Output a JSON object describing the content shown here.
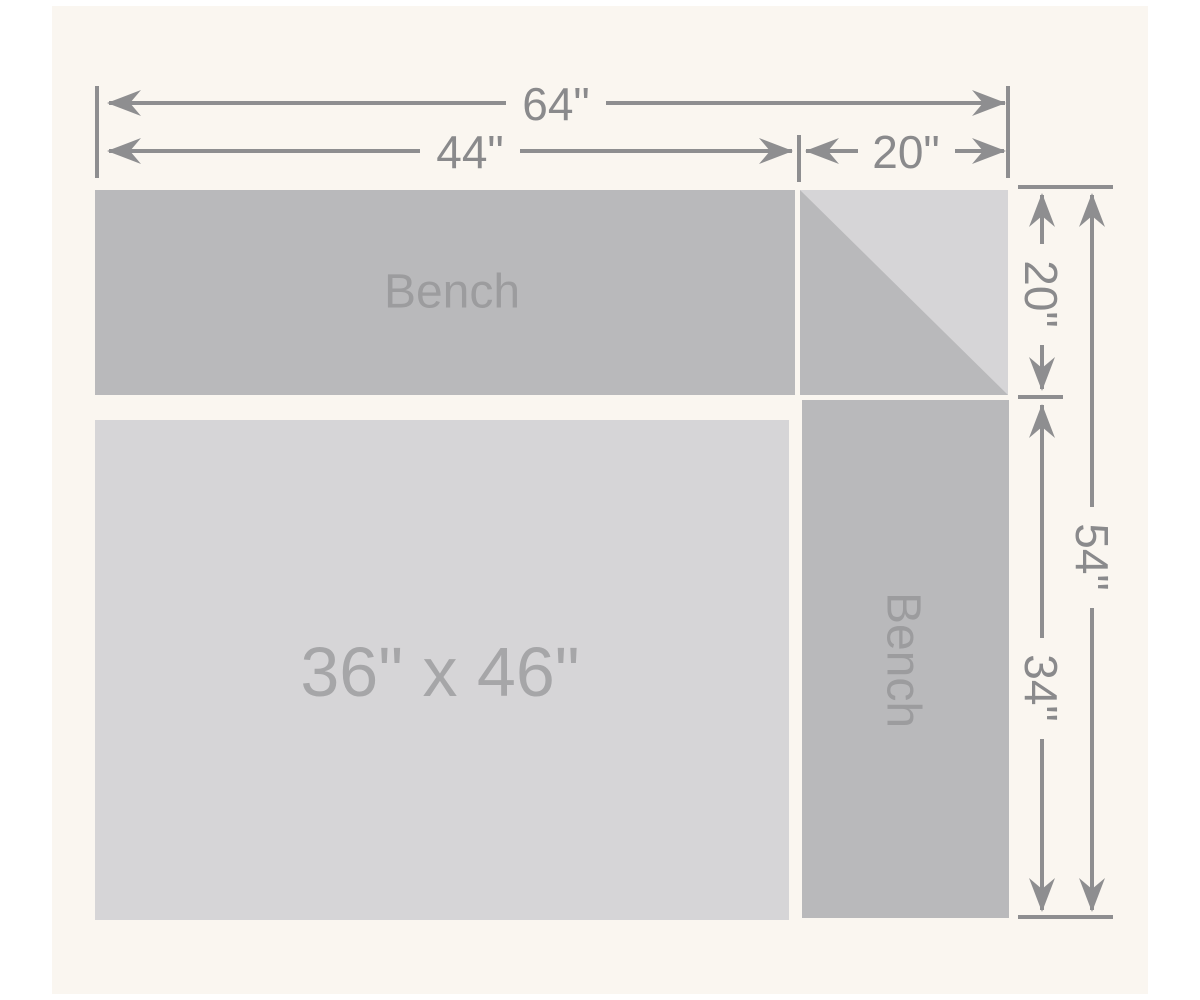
{
  "diagram": {
    "background_color": "#faf6f0",
    "margin_color": "#ffffff",
    "line_color": "#8e8e90",
    "dimension_text_color": "#8a8a8c",
    "shapes": {
      "top_bench": {
        "label": "Bench",
        "fill": "#b9b9bb",
        "label_color": "#9c9c9e"
      },
      "side_bench": {
        "label": "Bench",
        "fill": "#b9b9bb",
        "label_color": "#9c9c9e"
      },
      "corner_seat": {
        "fill_light": "#d6d5d7",
        "fill_dark": "#b9b9bb"
      },
      "table": {
        "label": "36\" x 46\"",
        "fill": "#d6d5d7",
        "label_color": "#a6a6a8"
      }
    },
    "dimensions": {
      "total_width": "64\"",
      "top_bench_length": "44\"",
      "corner_width": "20\"",
      "corner_height": "20\"",
      "total_depth": "54\"",
      "side_bench_length": "34\""
    }
  }
}
